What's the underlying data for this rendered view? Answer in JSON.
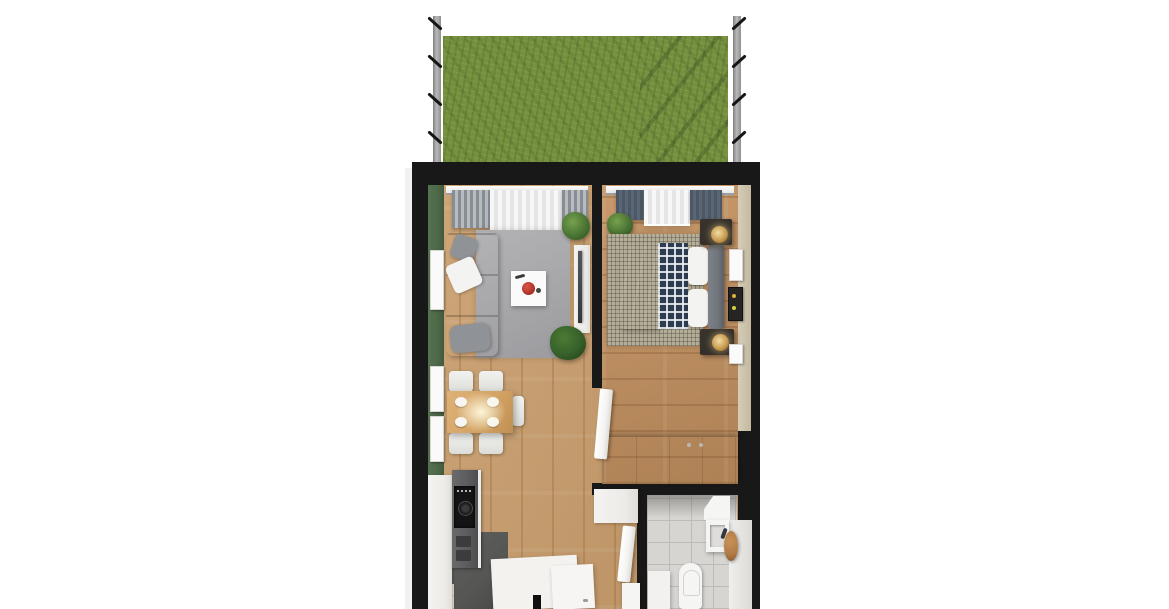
{
  "palette": {
    "background": "#ffffff",
    "wall_black": "#181818",
    "wall_face_white": "#f2f1ef",
    "grass_green": "#75903e",
    "fence_gray": "#b9b9b9",
    "accent_wall_green": "#4d6947",
    "floor_wood": "#c89c6a",
    "bedroom_wood": "#c2905f",
    "kitchen_floor_dark": "#555554",
    "tile_light": "#d7d5d1",
    "tile_grout": "#bdbbb7",
    "rug_gray": "#a9a9ac",
    "rug_checker_beige": "#b5ae97",
    "sofa_taupe": "#a89c92",
    "pillow_white": "#f3f3f1",
    "throw_gray": "#8f9296",
    "table_white": "#fafafa",
    "bowl_red": "#b23226",
    "dining_oak": "#d2a365",
    "chair_white": "#ebebe9",
    "bed_navy": "#3a4860",
    "plaid_navy": "#2e3c52",
    "headboard_gray": "#71757c",
    "nightstand_dark": "#2e2a26",
    "lamp_gold": "#c89b4f",
    "wardrobe_white": "#f0efec",
    "counter_gray": "#5d5d5f",
    "cooktop_black": "#141414",
    "cabinet_white": "#edebe8",
    "island_white": "#f3f2ef",
    "fixture_white": "#f5f5f3",
    "stool_wood": "#b07a45",
    "drape_gray": "#979da3",
    "drape_slate": "#5a6673",
    "sheer_white": "#f7f7f7",
    "plant_green": "#4a7434",
    "door_white": "#f4f3f1"
  },
  "scene": {
    "type": "3d-floor-plan-render",
    "garden_terrace": [
      "grass-lawn",
      "fence-left",
      "fence-right"
    ],
    "living_room": [
      "green-accent-wall",
      "window-sheer-curtain",
      "window-drapes",
      "sofa",
      "white-pillow",
      "gray-pillow",
      "throw-blanket",
      "area-rug",
      "coffee-table",
      "red-bowl",
      "tv-sideboard",
      "tv",
      "corner-plant",
      "floor-plant",
      "wall-art-frames",
      "dining-table",
      "dining-chairs",
      "dinner-plates",
      "pendant-light-glow"
    ],
    "kitchen": [
      "tall-cabinet",
      "counter",
      "cooktop",
      "drawers",
      "kitchen-island",
      "island-handle",
      "dark-floor",
      "floor-mat",
      "tile-patch"
    ],
    "bedroom": [
      "window-sheer-curtain",
      "window-drapes",
      "bed",
      "navy-duvet",
      "plaid-blanket",
      "pillows",
      "headboard",
      "nightstands",
      "gold-table-lamps",
      "checkered-rug",
      "plant",
      "wall-art-frames",
      "wardrobe",
      "door"
    ],
    "bathroom": [
      "tiled-floor",
      "vanity-cabinet",
      "sink",
      "wooden-stool",
      "toilet",
      "shower-tray",
      "door"
    ],
    "hallway": [
      "wall-cabinet",
      "laundry-unit"
    ]
  }
}
